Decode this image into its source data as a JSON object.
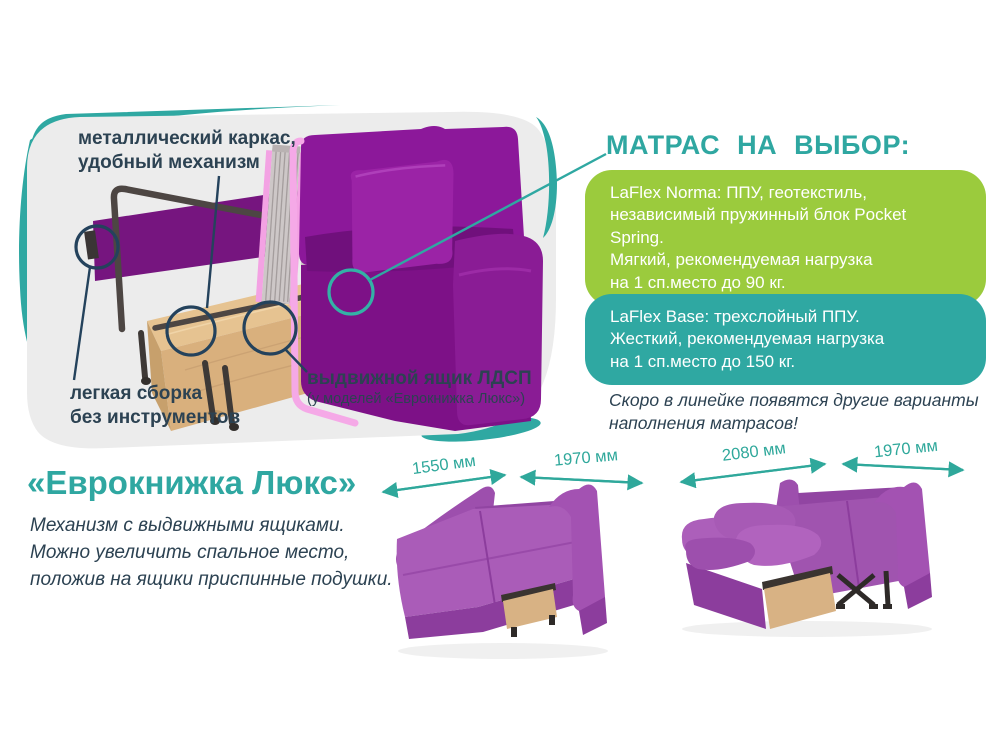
{
  "colors": {
    "teal": "#2FA8A2",
    "green": "#9BCB3D",
    "text_dark": "#2C4252",
    "card_bg": "#ECECEC",
    "sofa_purple": "#8C189A",
    "sofa_lilac": "#A558B4",
    "wood": "#D9B180",
    "trim_pink": "#F5A9E7"
  },
  "cutaway": {
    "frame_label": "металлический каркас,\nудобный механизм",
    "assembly_label": "легкая сборка\nбез инструментов",
    "drawer_label": "выдвижной ящик ЛДСП",
    "drawer_note": "(у моделей «Еврокнижка Люкс»)"
  },
  "mattress": {
    "heading": "МАТРАС НА ВЫБОР:",
    "option_norma": "LaFlex Norma: ППУ, геотекстиль,\nнезависимый пружинный блок Pocket Spring.\nМягкий, рекомендуемая нагрузка\nна 1 сп.место до 90 кг.",
    "option_base": "LaFlex Base: трехслойный ППУ.\nЖесткий, рекомендуемая нагрузка\nна 1 сп.место до 150 кг.",
    "note": "Скоро в линейке появятся другие варианты\nнаполнения матрасов!"
  },
  "model": {
    "heading": "«Еврокнижка Люкс»",
    "description": "Механизм с выдвижными ящиками.\nМожно увеличить спальное место,\nположив на ящики приспинные подушки."
  },
  "dimensions": {
    "labels": [
      "1550 мм",
      "1970 мм",
      "2080 мм",
      "1970 мм"
    ]
  }
}
